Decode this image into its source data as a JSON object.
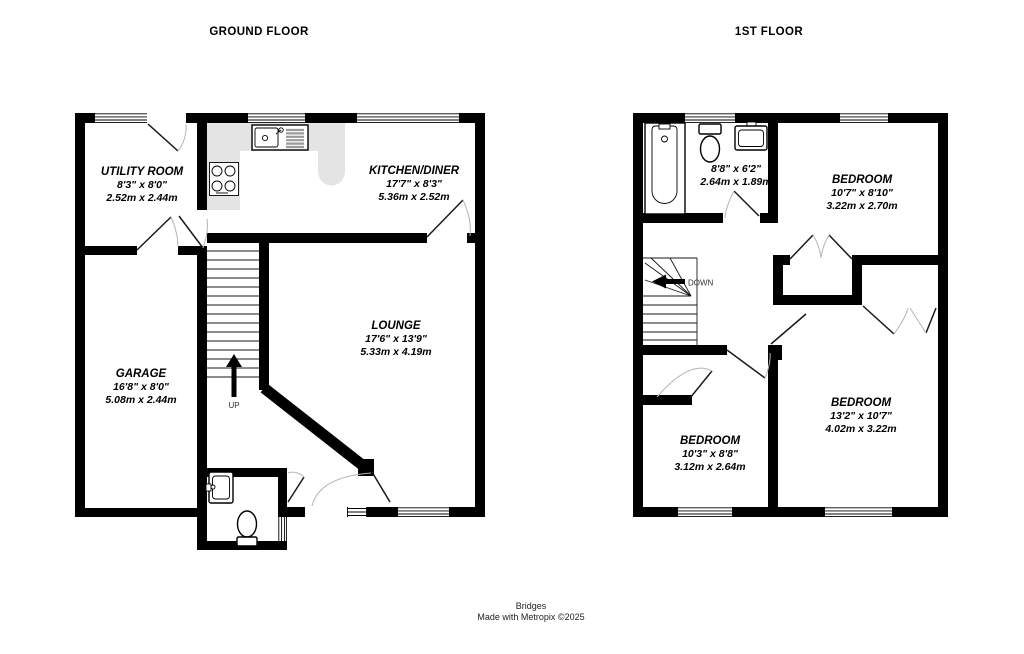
{
  "titles": {
    "ground_floor": "GROUND FLOOR",
    "first_floor": "1ST FLOOR"
  },
  "ground_floor": {
    "rooms": {
      "utility": {
        "name": "UTILITY ROOM",
        "imperial": "8'3\"  x 8'0\"",
        "metric": "2.52m  x 2.44m"
      },
      "kitchen": {
        "name": "KITCHEN/DINER",
        "imperial": "17'7\"  x 8'3\"",
        "metric": "5.36m  x 2.52m"
      },
      "lounge": {
        "name": "LOUNGE",
        "imperial": "17'6\"  x 13'9\"",
        "metric": "5.33m  x 4.19m"
      },
      "garage": {
        "name": "GARAGE",
        "imperial": "16'8\"  x 8'0\"",
        "metric": "5.08m  x 2.44m"
      }
    },
    "stair_label": "UP"
  },
  "first_floor": {
    "rooms": {
      "bathroom": {
        "imperial": "8'8\"  x 6'2\"",
        "metric": "2.64m  x 1.89m"
      },
      "bedroom1": {
        "name": "BEDROOM",
        "imperial": "10'7\"  x 8'10\"",
        "metric": "3.22m  x 2.70m"
      },
      "bedroom2": {
        "name": "BEDROOM",
        "imperial": "13'2\"  x 10'7\"",
        "metric": "4.02m  x 3.22m"
      },
      "bedroom3": {
        "name": "BEDROOM",
        "imperial": "10'3\"  x 8'8\"",
        "metric": "3.12m  x 2.64m"
      }
    },
    "stair_label": "DOWN"
  },
  "footer": {
    "company": "Bridges",
    "credit": "Made with Metropix ©2025"
  },
  "colors": {
    "wall": "#000000",
    "counter": "#e4e4e4",
    "arc": "#b5b5b5"
  }
}
